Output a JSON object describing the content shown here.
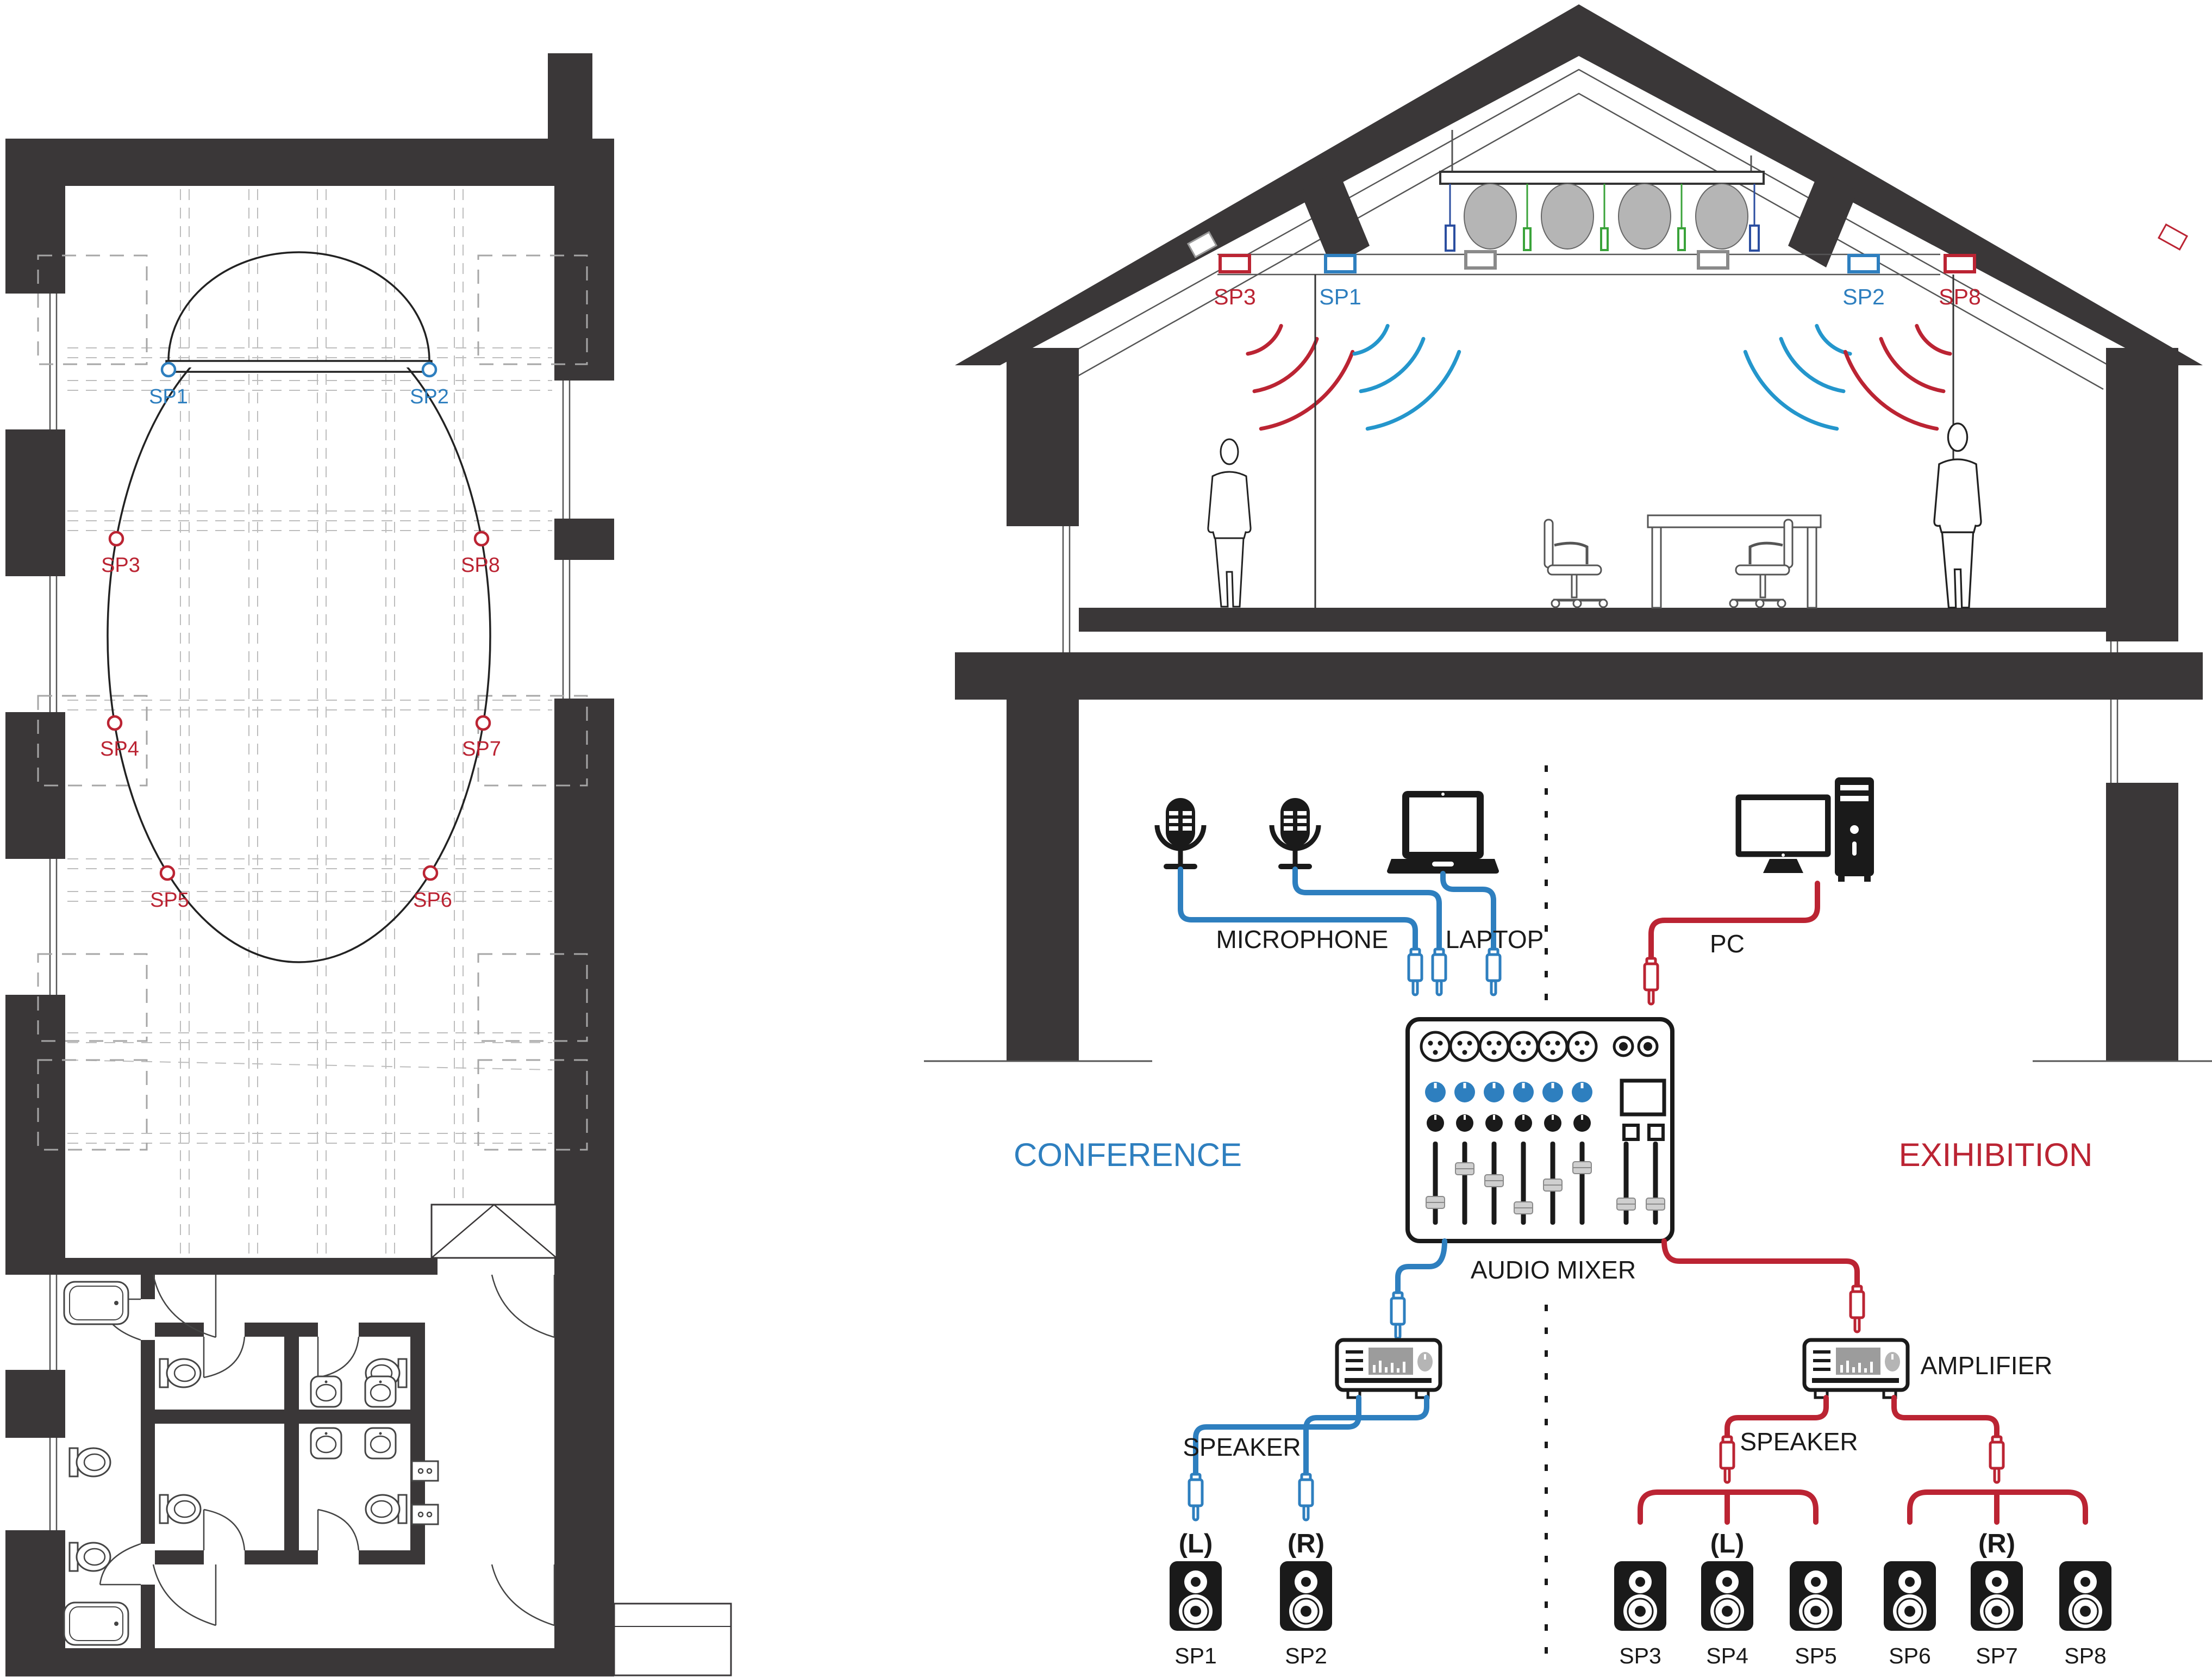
{
  "colors": {
    "conference_blue": "#2e7fbf",
    "exhibition_red": "#bb2433",
    "wave_blue": "#2496cc",
    "dark": "#231f20",
    "wall_gray": "#3a3738",
    "fan_gray": "#b5b5b5",
    "hanger_green": "#3aa33a",
    "hanger_navy": "#2b4ea0"
  },
  "floor_plan": {
    "speakers": {
      "sp1": "SP1",
      "sp2": "SP2",
      "sp3": "SP3",
      "sp4": "SP4",
      "sp5": "SP5",
      "sp6": "SP6",
      "sp7": "SP7",
      "sp8": "SP8"
    }
  },
  "section": {
    "labels": {
      "sp3": "SP3",
      "sp1": "SP1",
      "sp2": "SP2",
      "sp8": "SP8"
    }
  },
  "diagram": {
    "inputs": {
      "microphone": "MICROPHONE",
      "laptop": "LAPTOP",
      "pc": "PC"
    },
    "zones": {
      "left": "CONFERENCE",
      "right": "EXIHIBITION"
    },
    "mixer": "AUDIO MIXER",
    "amplifier": "AMPLIFIER",
    "speaker_left": "SPEAKER",
    "speaker_right": "SPEAKER",
    "channels": {
      "conf_l": "(L)",
      "conf_r": "(R)",
      "exh_l": "(L)",
      "exh_r": "(R)"
    },
    "speakers": [
      "SP1",
      "SP2",
      "SP3",
      "SP4",
      "SP5",
      "SP6",
      "SP7",
      "SP8"
    ]
  }
}
